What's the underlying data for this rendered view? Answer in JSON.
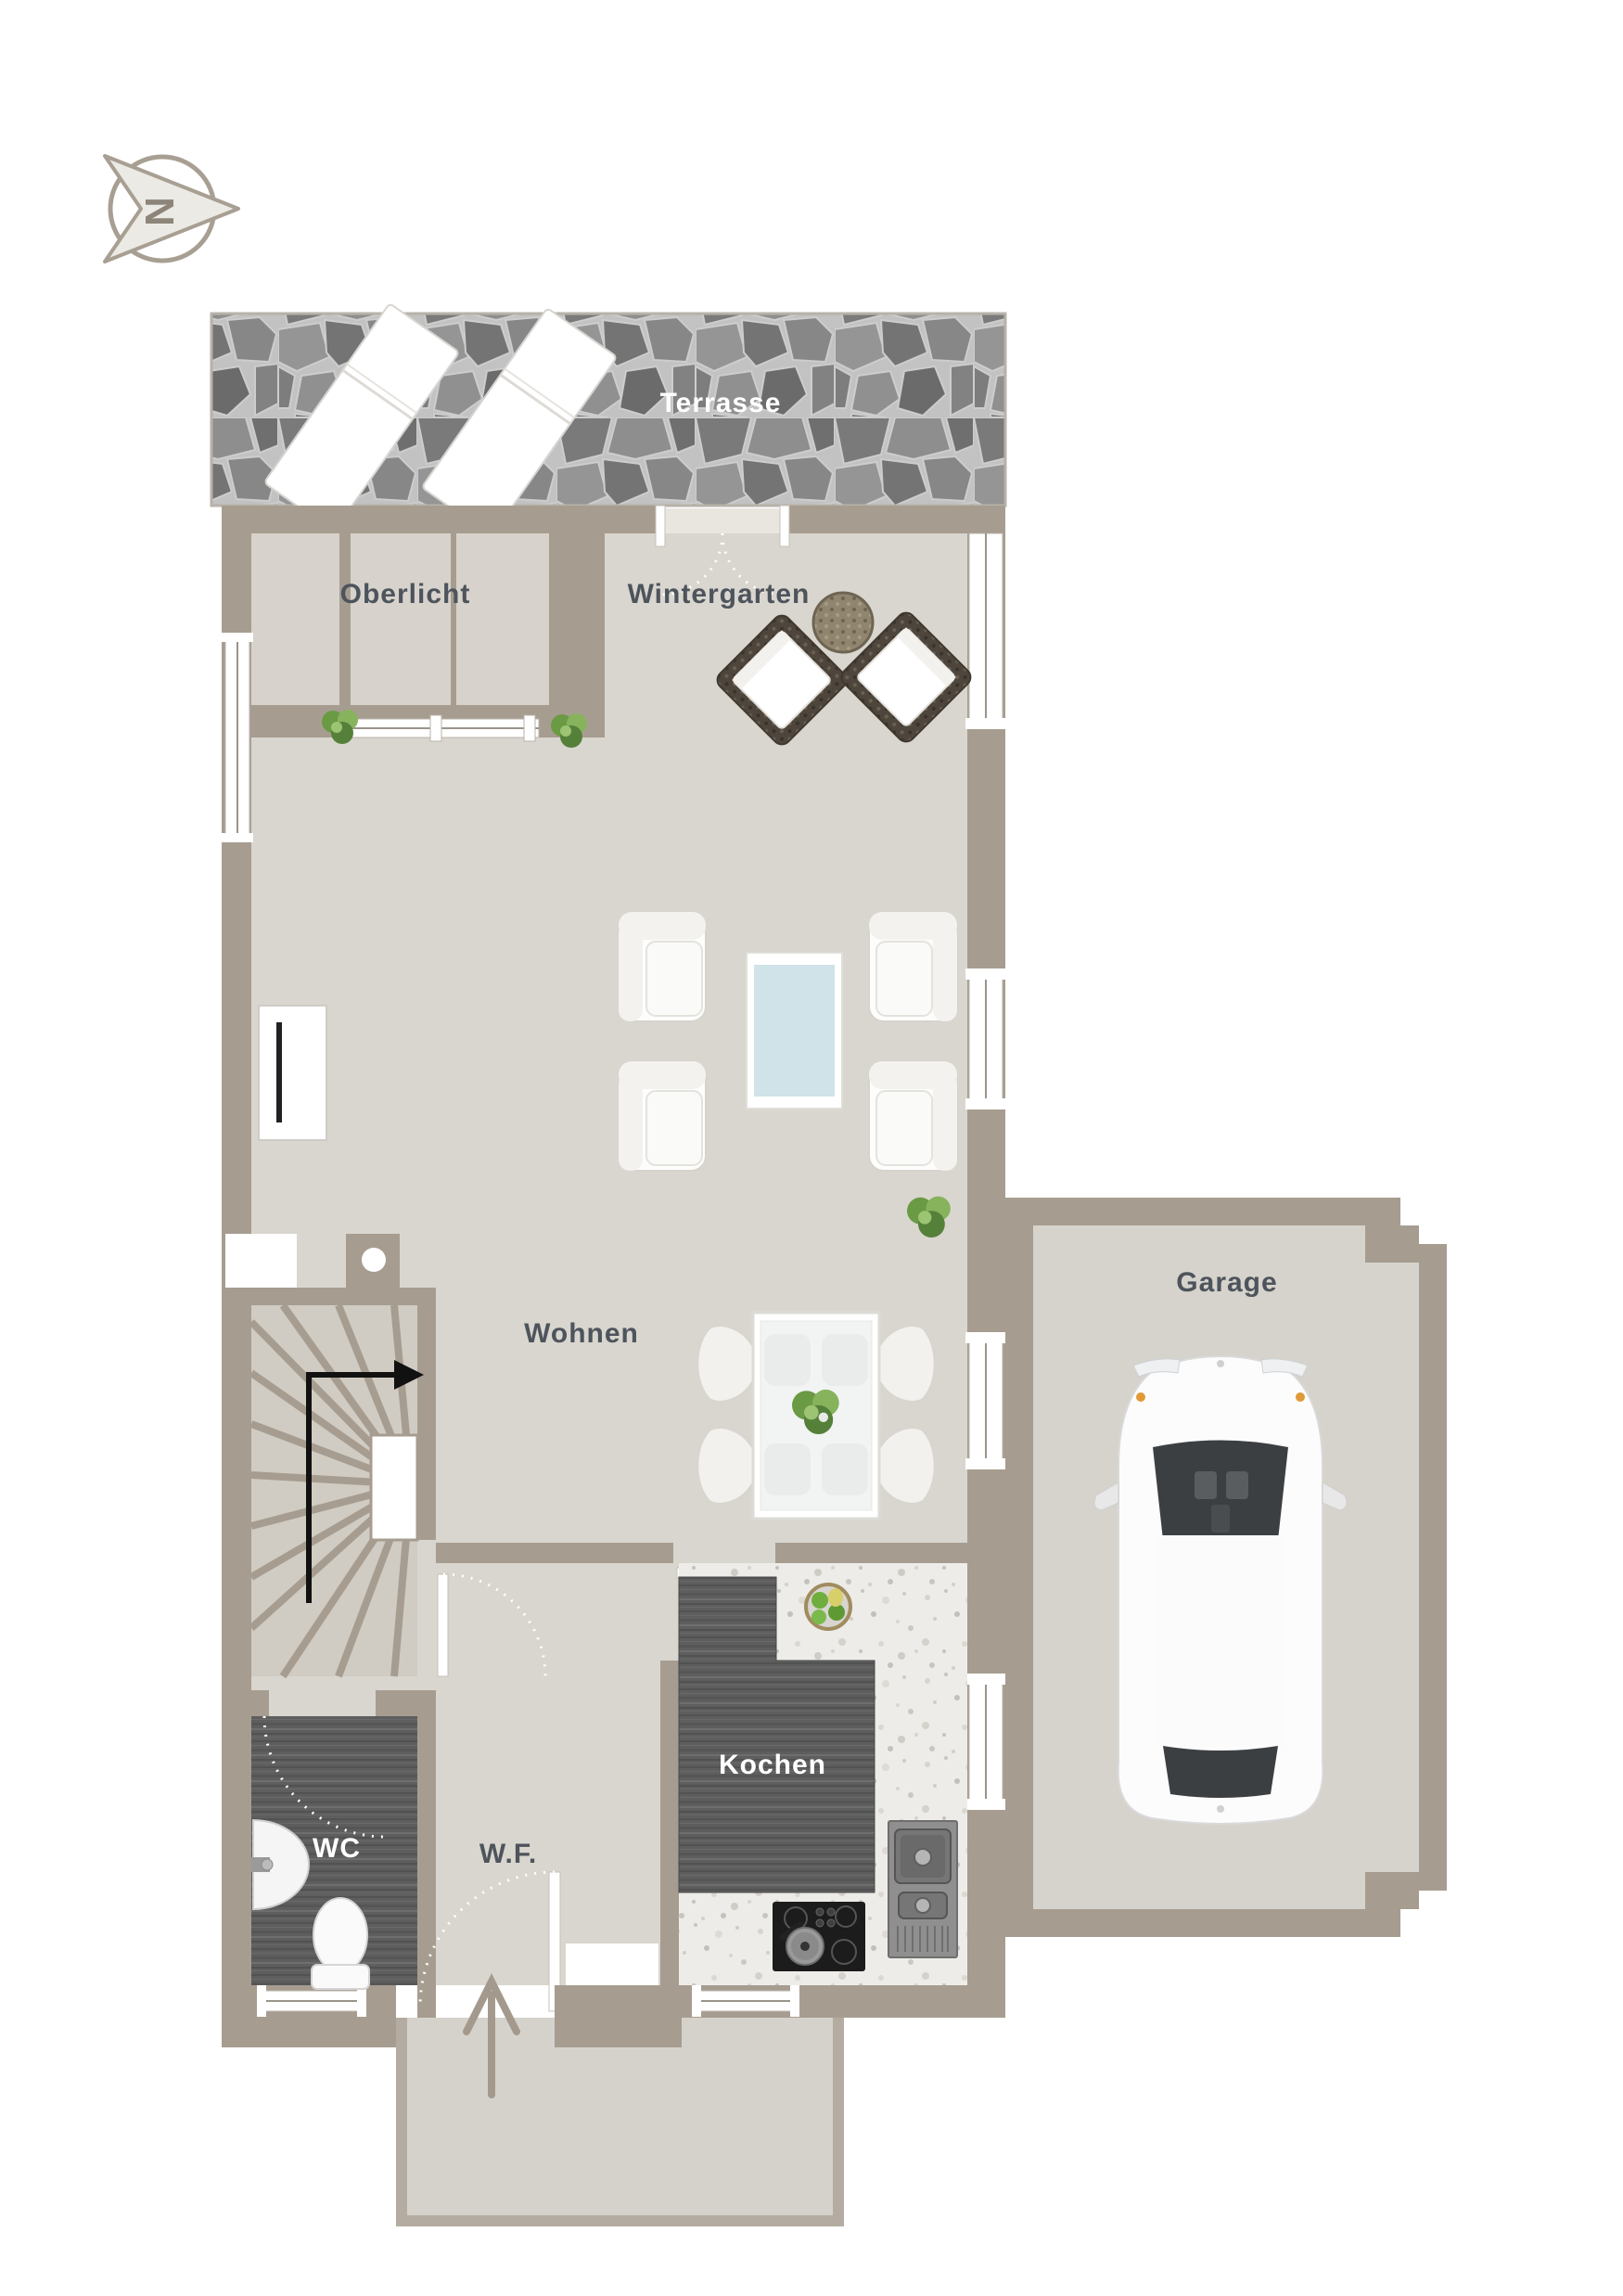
{
  "compass": {
    "letter": "N"
  },
  "rooms": {
    "terrasse": "Terrasse",
    "oberlicht": "Oberlicht",
    "wintergarten": "Wintergarten",
    "wohnen": "Wohnen",
    "garage": "Garage",
    "kochen": "Kochen",
    "wc": "WC",
    "wf": "W.F."
  },
  "colors": {
    "wall": "#a69d90",
    "floor": "#d9d6cf",
    "stair_floor": "#d0ccc3",
    "terrace_stone": "#8a8a8a",
    "counter_wood": "#5e5e5e",
    "kitchen_floor": "#edece8",
    "glass_table": "#cfe3e8",
    "label_dark": "#4e545c",
    "label_light": "#ffffff",
    "compass": "#8d8579",
    "stair_arrow": "#111111"
  }
}
